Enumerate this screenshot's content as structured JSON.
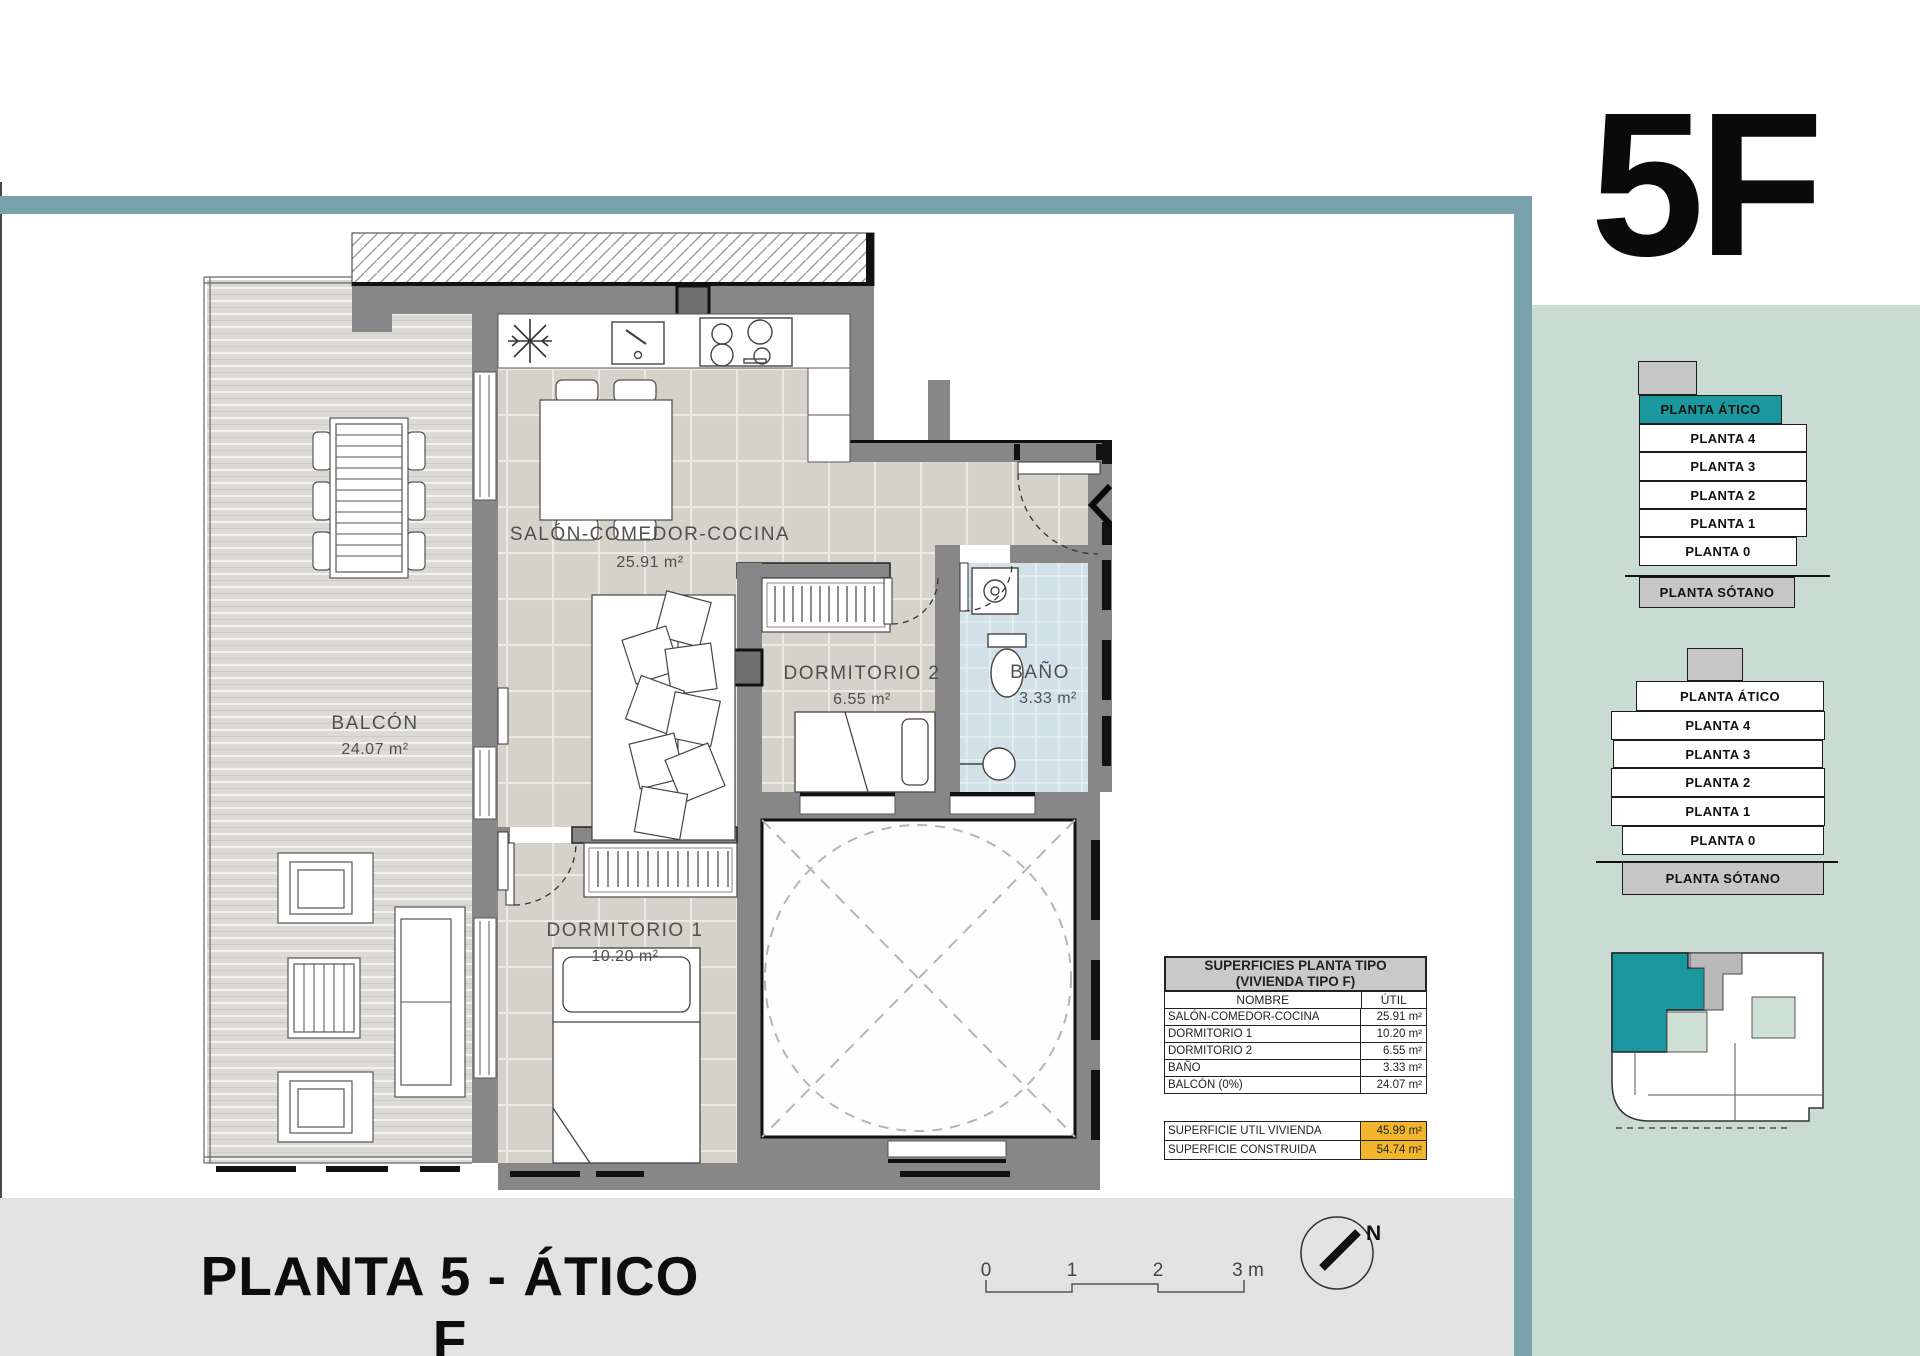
{
  "page": {
    "unit_code": "5F",
    "title": "PLANTA 5 - ÁTICO F"
  },
  "colors": {
    "accent_teal": "#1b989d",
    "frame_teal": "#7aa2ab",
    "sidebar_green": "#c9dbd2",
    "highlight_orange": "#f2b52c",
    "wall_grey": "#878787"
  },
  "plan": {
    "rooms": [
      {
        "id": "salon",
        "label": "SALÓN-COMEDOR-COCINA",
        "area": "25.91 m²"
      },
      {
        "id": "dormitorio2",
        "label": "DORMITORIO 2",
        "area": "6.55 m²"
      },
      {
        "id": "bano",
        "label": "BAÑO",
        "area": "3.33 m²"
      },
      {
        "id": "balcon",
        "label": "BALCÓN",
        "area": "24.07 m²"
      },
      {
        "id": "dormitorio1",
        "label": "DORMITORIO 1",
        "area": "10.20 m²"
      }
    ]
  },
  "table": {
    "title_line1": "SUPERFICIES PLANTA TIPO",
    "title_line2": "(VIVIENDA TIPO F)",
    "col_name": "NOMBRE",
    "col_value": "ÚTIL",
    "rows": [
      {
        "name": "SALÓN-COMEDOR-COCINA",
        "value": "25.91 m²"
      },
      {
        "name": "DORMITORIO 1",
        "value": "10.20 m²"
      },
      {
        "name": "DORMITORIO 2",
        "value": "6.55 m²"
      },
      {
        "name": "BAÑO",
        "value": "3.33 m²"
      },
      {
        "name": "BALCÓN (0%)",
        "value": "24.07 m²"
      }
    ],
    "totals": [
      {
        "name": "SUPERFICIE UTIL VIVIENDA",
        "value": "45.99 m²"
      },
      {
        "name": "SUPERFICIE CONSTRUIDA",
        "value": "54.74 m²"
      }
    ]
  },
  "stacks": {
    "stack1": {
      "floors": [
        "PLANTA ÁTICO",
        "PLANTA 4",
        "PLANTA 3",
        "PLANTA 2",
        "PLANTA 1",
        "PLANTA 0",
        "PLANTA SÓTANO"
      ],
      "highlighted": "PLANTA ÁTICO"
    },
    "stack2": {
      "floors": [
        "PLANTA ÁTICO",
        "PLANTA 4",
        "PLANTA 3",
        "PLANTA 2",
        "PLANTA 1",
        "PLANTA 0",
        "PLANTA SÓTANO"
      ]
    }
  },
  "scalebar": {
    "ticks": [
      "0",
      "1",
      "2",
      "3 m"
    ]
  },
  "compass": {
    "label": "N"
  }
}
